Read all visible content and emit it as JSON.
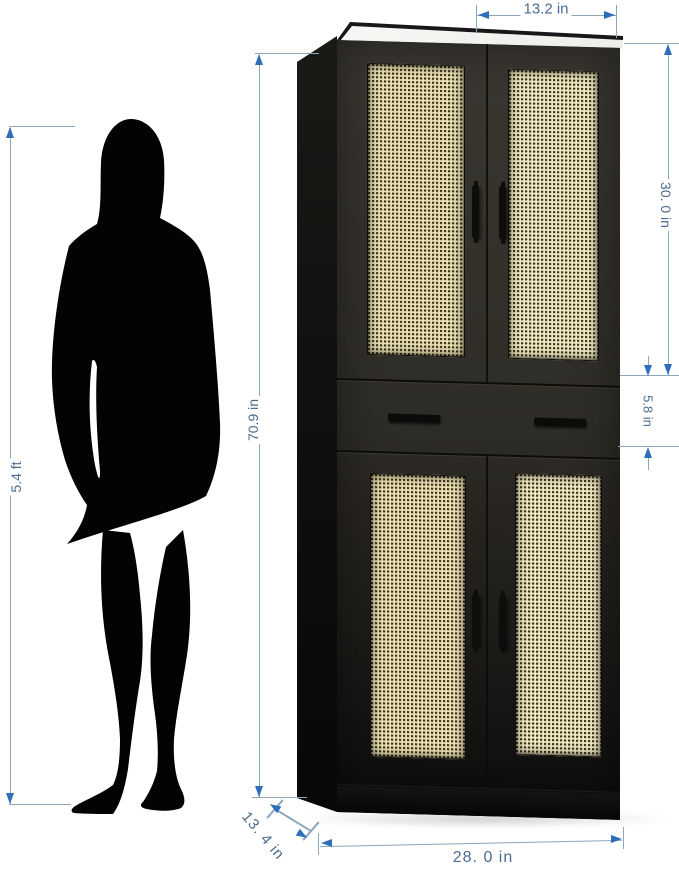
{
  "diagram": {
    "kind": "furniture dimension diagram",
    "annotations": {
      "person_height": "5.4 ft",
      "total_height": "70.9 in",
      "top_door_width": "13.2 in",
      "upper_cabinet_height": "30. 0 in",
      "drawer_height": "5.8 in",
      "depth": "13. 4 in",
      "width": "28. 0 in"
    },
    "objects": {
      "person": "standing woman silhouette",
      "cabinet": "tall black cabinet, four rattan-panel doors, one drawer",
      "door_handle_count": 4,
      "drawer_handle_count": 2
    },
    "colors": {
      "dimension_line": "#8ba6bd",
      "dimension_arrow": "#2e6eb8",
      "dimension_text": "#4b6b93",
      "cabinet_body": "#2e2c26",
      "cabinet_side": "#0f0e0c",
      "rattan_panel": "#eae0b2",
      "background": "#ffffff"
    }
  }
}
